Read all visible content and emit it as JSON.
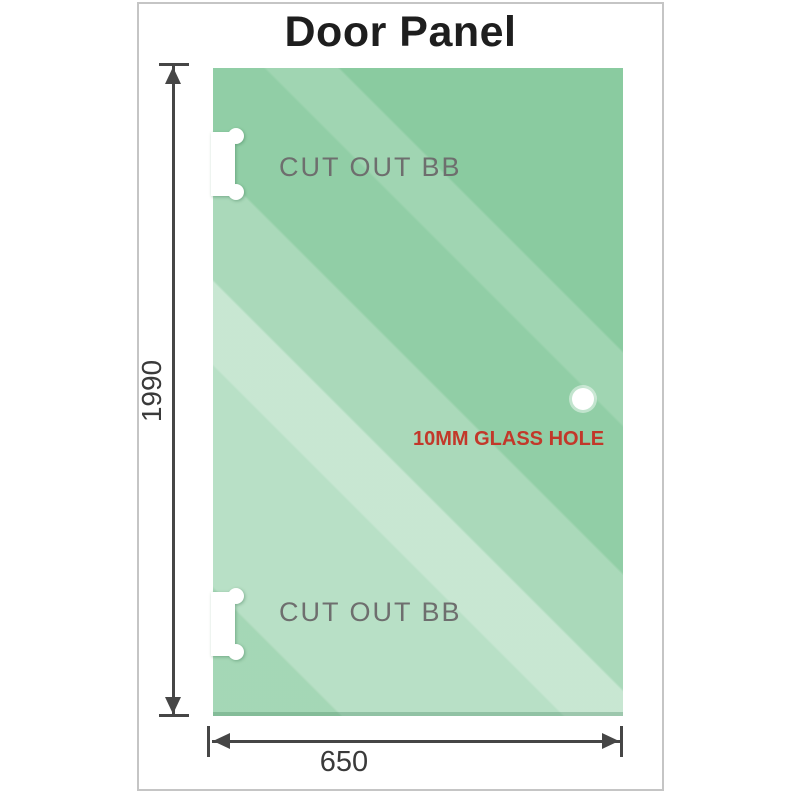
{
  "title": "Door Panel",
  "panel": {
    "cutout_top_label": "CUT OUT BB",
    "cutout_bottom_label": "CUT OUT BB",
    "hole_label": "10MM GLASS HOLE"
  },
  "dimensions": {
    "height_label": "1990",
    "width_label": "650"
  },
  "colors": {
    "glass_base": "#85c99c",
    "glass_highlight": "#cdebd3",
    "frame_border": "#c5c5c5",
    "title_text": "#1e1e1e",
    "cutout_text": "#6e6e6e",
    "hole_text": "#c2382a",
    "dimension_lines": "#464646"
  }
}
